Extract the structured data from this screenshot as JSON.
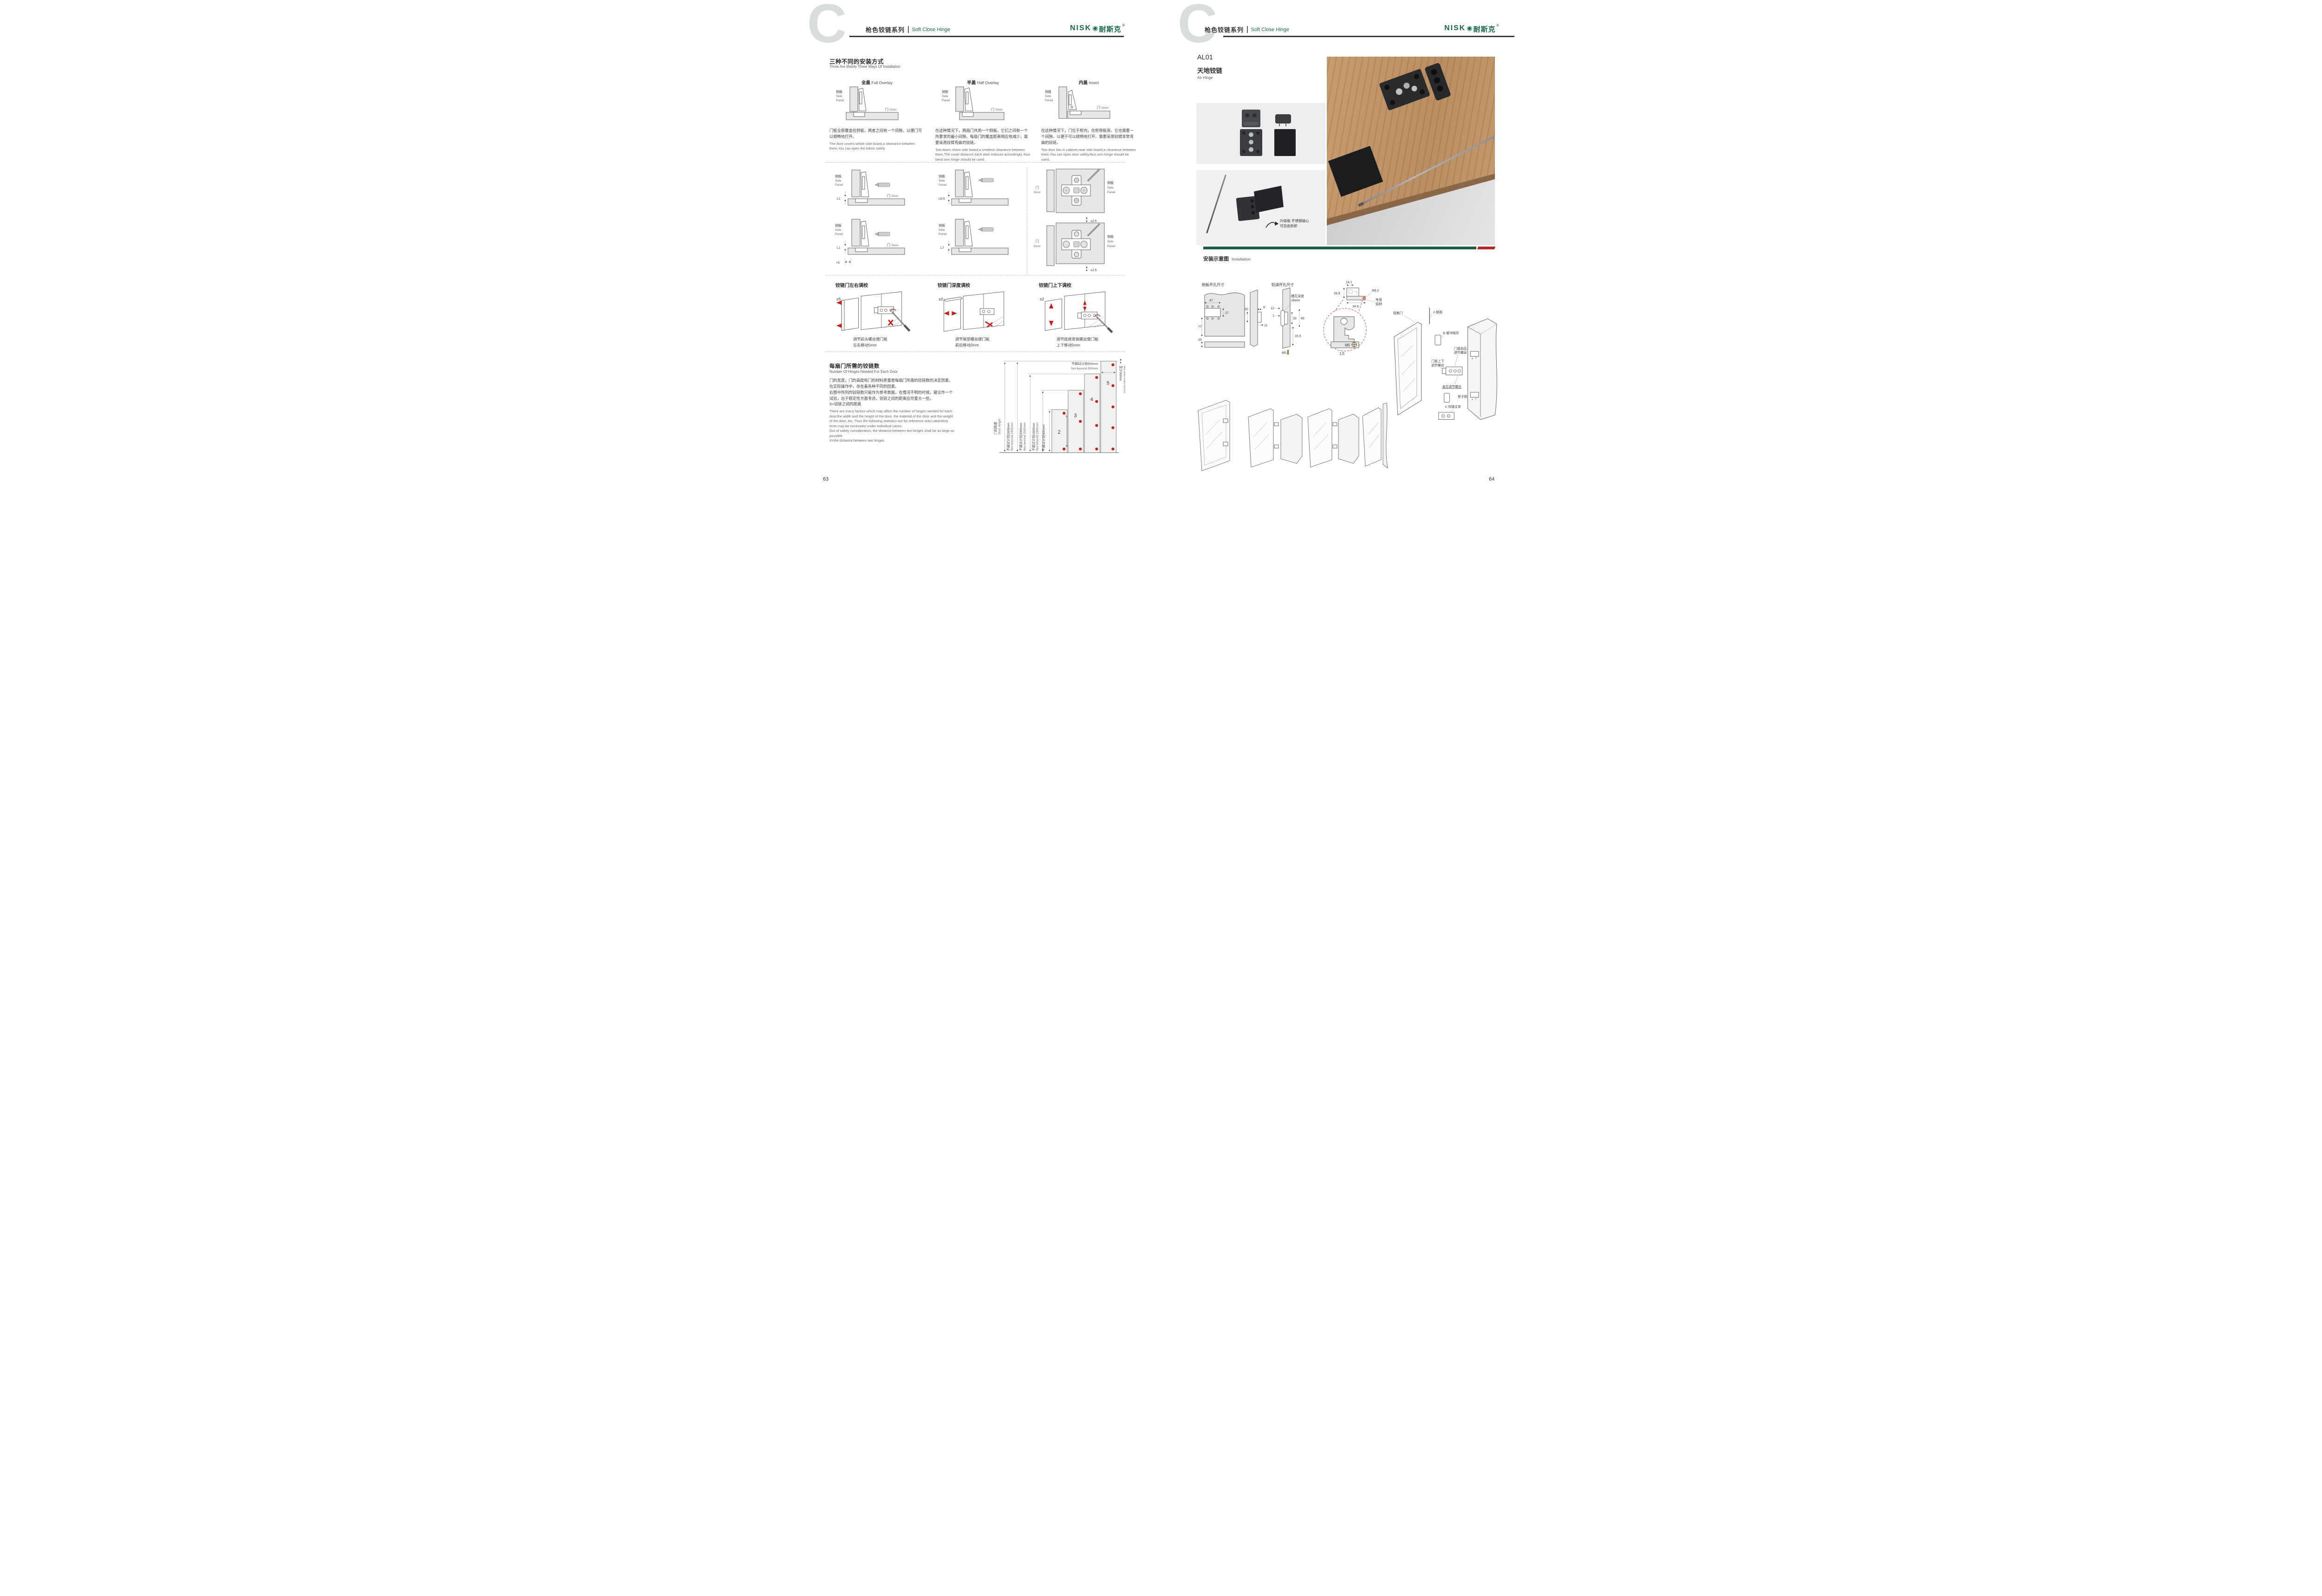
{
  "brand": {
    "badge": "C",
    "latin": "NISK",
    "o_glyph": "◉",
    "zh": "耐斯克",
    "reg": "®"
  },
  "header": {
    "series_zh": "枪色铰链系列",
    "series_en": "Soft Close Hinge"
  },
  "shared": {
    "side_zh": "侧板",
    "side_en1": "Side",
    "side_en2": "Panel",
    "door_zh": "门",
    "door_en": "Door"
  },
  "left": {
    "page_no": "63",
    "install_ways": {
      "title_zh": "三种不同的安装方式",
      "title_en": "Three Are Mainly Three Ways Of Installation",
      "cols": [
        {
          "head_zh": "全盖",
          "head_en": "Full Overlay",
          "zh": "门板全部覆盖住侧板，两者之间有一个间隙，以便门可以顺畅地打开。",
          "en": "The door covers whole side board,a clearance between them,You can open the bdoor safely."
        },
        {
          "head_zh": "半盖",
          "head_en": "Half Overlay",
          "zh": "在这种情况下，两扇门共用一个侧板。它们之间有一个所要求的最小间隙。每扇门的覆盖距离相应地减少，需要采用铰臂弯曲的铰链。",
          "en": "Tow doors share side board,a smallest clearance between them,The cover distance each door reduces accordingly, thus bend arm hinge should be used."
        },
        {
          "head_zh": "内盖",
          "head_en": "Insert",
          "zh": "在这种情况下，门位于柜内，在柜侧板旁。它也需要一个间隙。以便于可以顺畅地打开。需要采用铰臂非常弯曲的铰链。",
          "en": "Tow door lies in cabinet,near side board,a clearance between them.You can open door safely,thus arm hinge should be used."
        }
      ]
    },
    "offsets": {
      "d1": "L1",
      "d2": "L0.5",
      "d3": "L1",
      "d3b": "+5",
      "d4": "L7",
      "dp1": "±2.5",
      "dp2": "±2.5"
    },
    "adjust": [
      {
        "title": "铰链门左右调校",
        "dim": "±5",
        "cap1": "调节前头螺丝使门板",
        "cap2": "左右移动5mm"
      },
      {
        "title": "铰链门深度调校",
        "dim": "±2",
        "cap1": "调节尾部螺丝使门板",
        "cap2": "前后移动2mm"
      },
      {
        "title": "铰链门上下调校",
        "dim": "±2",
        "cap1": "调节底座安装螺丝使门板",
        "cap2": "上下移动5mm"
      }
    ],
    "hinge_count": {
      "title_zh": "每扇门所需的铰链数",
      "title_en": "Number Of Hinges Needed For Each Door",
      "zh_lines": [
        "门的宽度，门的高度和门的材料质量是每扇门所需的铰链数的决定因素。",
        "在实际操作中，存在着各种不同的因素。",
        "右图中所列的铰链数只能作为参考数据，在情况不明的时候，建议作一个",
        "试验，出于稳定性方面考虑，铰链之间的距离应尽量大一些。",
        "X=铰链之间的距离"
      ],
      "en_lines": [
        "There are many factors which may affect the number of hinges needed for each",
        "door.the width and the height of the door, the material of the door and the weight",
        "of the door, etc, Thus the following statistics are for reference only.Laboratory",
        "tests may be necessary under individual cases.",
        "Out of safety consideration, the distance between two hinges shall be as large as",
        "possible.",
        "X=the distance between two hinges"
      ]
    }
  },
  "chart_data": {
    "type": "bar",
    "title_zh": "每扇门所需的铰链数",
    "title_en": "Number Of Hinges Needed For Each Door",
    "axis_zh": "门的高度",
    "axis_en": "Door height",
    "bars": [
      {
        "hinges": "2",
        "height_zh": "不超过计划900mm",
        "height_en": "Not bevond 900mm"
      },
      {
        "hinges": "3",
        "height_zh": "不超过计划1600mm",
        "height_en": "Not bevond 1600mm"
      },
      {
        "hinges": "4",
        "height_zh": "不超过计划2000mm",
        "height_en": "Not bevond 2000mm"
      },
      {
        "hinges": "5",
        "height_zh": "不超过计划2400mm",
        "height_en": "Not bevond 2400mm"
      }
    ],
    "door_width_zh": "不超过计划600mm",
    "door_width_en": "Not bevond 600mm",
    "edge_zh": "至少90mm",
    "edge_en": "Not less than 90mm",
    "ylim": [
      0,
      2400
    ],
    "bar_fill": "#f1f1f1",
    "dot_color": "#c8201d"
  },
  "right": {
    "page_no": "64",
    "product": {
      "code": "AL01",
      "name_zh": "天地铰链",
      "name_en": "Air Hinge"
    },
    "photo_note": {
      "line1": "升级版·不锈钢轴心",
      "line2": "可自由拆卸"
    },
    "install": {
      "title_zh": "安装示意图",
      "title_en": "Installation"
    },
    "side_drill": {
      "title": "侧板开孔尺寸",
      "d47": "47",
      "d27": "27",
      "d77": "77",
      "d25": "25"
    },
    "alu_drill": {
      "title": "铝调开孔尺寸",
      "d20": "20",
      "d8": "8",
      "d11": "11",
      "d12": "12",
      "d1": "1",
      "d33": "33",
      "d46": "46",
      "d155": "15.5",
      "m5": "M5",
      "slot1": "槽孔深度",
      "slot2": "18mm"
    },
    "detail": {
      "d141": "14.1",
      "d289": "28.9",
      "d349": "34.9",
      "dia": "Φ6.2",
      "alu1": "专用",
      "alu2": "铝材",
      "scale": "1:5",
      "m5": "M5"
    },
    "exploded": {
      "alu_door": "铝框门",
      "a_pin": "A 插销",
      "b_damper": "B 缓冲阻尼",
      "fb1": "门板前后",
      "fb2": "调节螺丝",
      "ud1": "门板上下",
      "ud2": "调节螺丝",
      "cover": "盖位调节螺丝",
      "cabinet": "柜子侧板",
      "c_body": "C 铰链主体"
    }
  },
  "colors": {
    "brand_green": "#176a4b",
    "bar_green": "#1d5c3c",
    "bar_red": "#b5292a",
    "accent_red": "#c8201d"
  }
}
